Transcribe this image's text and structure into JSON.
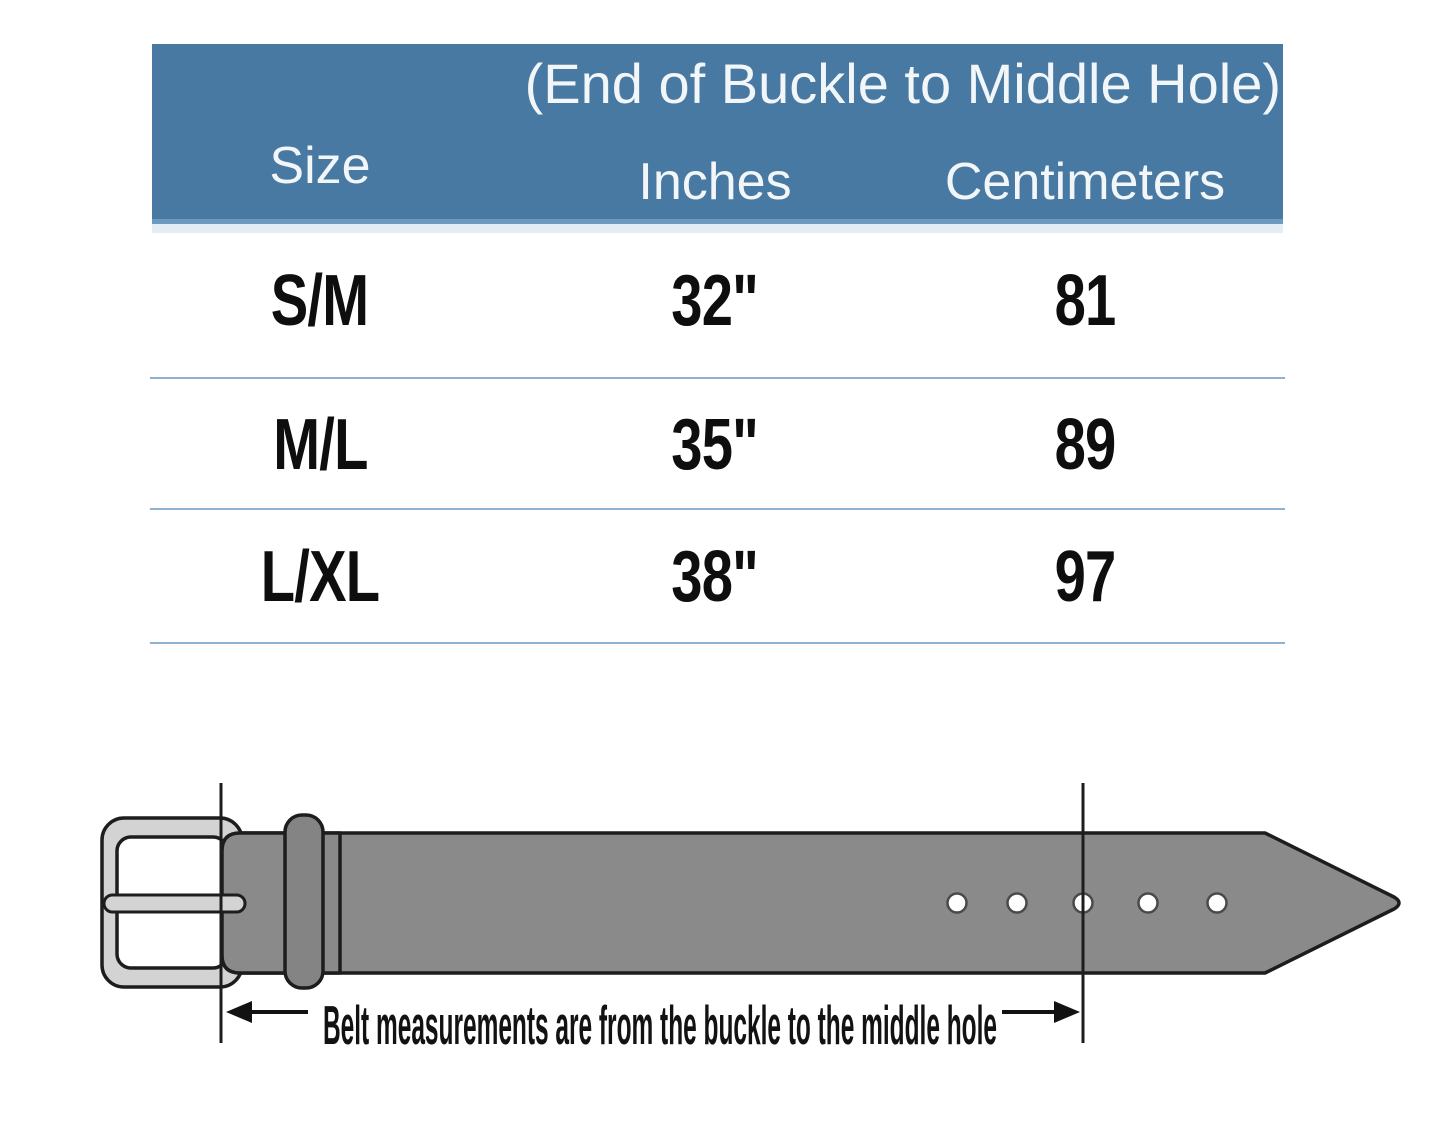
{
  "table": {
    "header": {
      "col_size": "Size",
      "span_title": "(End of Buckle to Middle Hole)",
      "col_inches": "Inches",
      "col_centimeters": "Centimeters"
    },
    "rows": [
      {
        "size": "S/M",
        "inches": "32\"",
        "centimeters": "81"
      },
      {
        "size": "M/L",
        "inches": "35\"",
        "centimeters": "89"
      },
      {
        "size": "L/XL",
        "inches": "38\"",
        "centimeters": "97"
      }
    ]
  },
  "diagram": {
    "caption": "Belt measurements are from the buckle to the middle hole",
    "holes_count": 5,
    "colors": {
      "header_bg": "#4779A2",
      "header_border": "#6E9ABF",
      "header_text": "#F2F6F9",
      "divider": "#8FB0CE",
      "row_text": "#0E0E0E",
      "strap": "#8A8A8A",
      "keeper": "#848484",
      "buckle": "#D3D3D3",
      "outline": "#1D1D1D",
      "hole_fill": "#FFFFFF",
      "hole_stroke": "#4A4A4A",
      "annotation": "#121212"
    }
  }
}
